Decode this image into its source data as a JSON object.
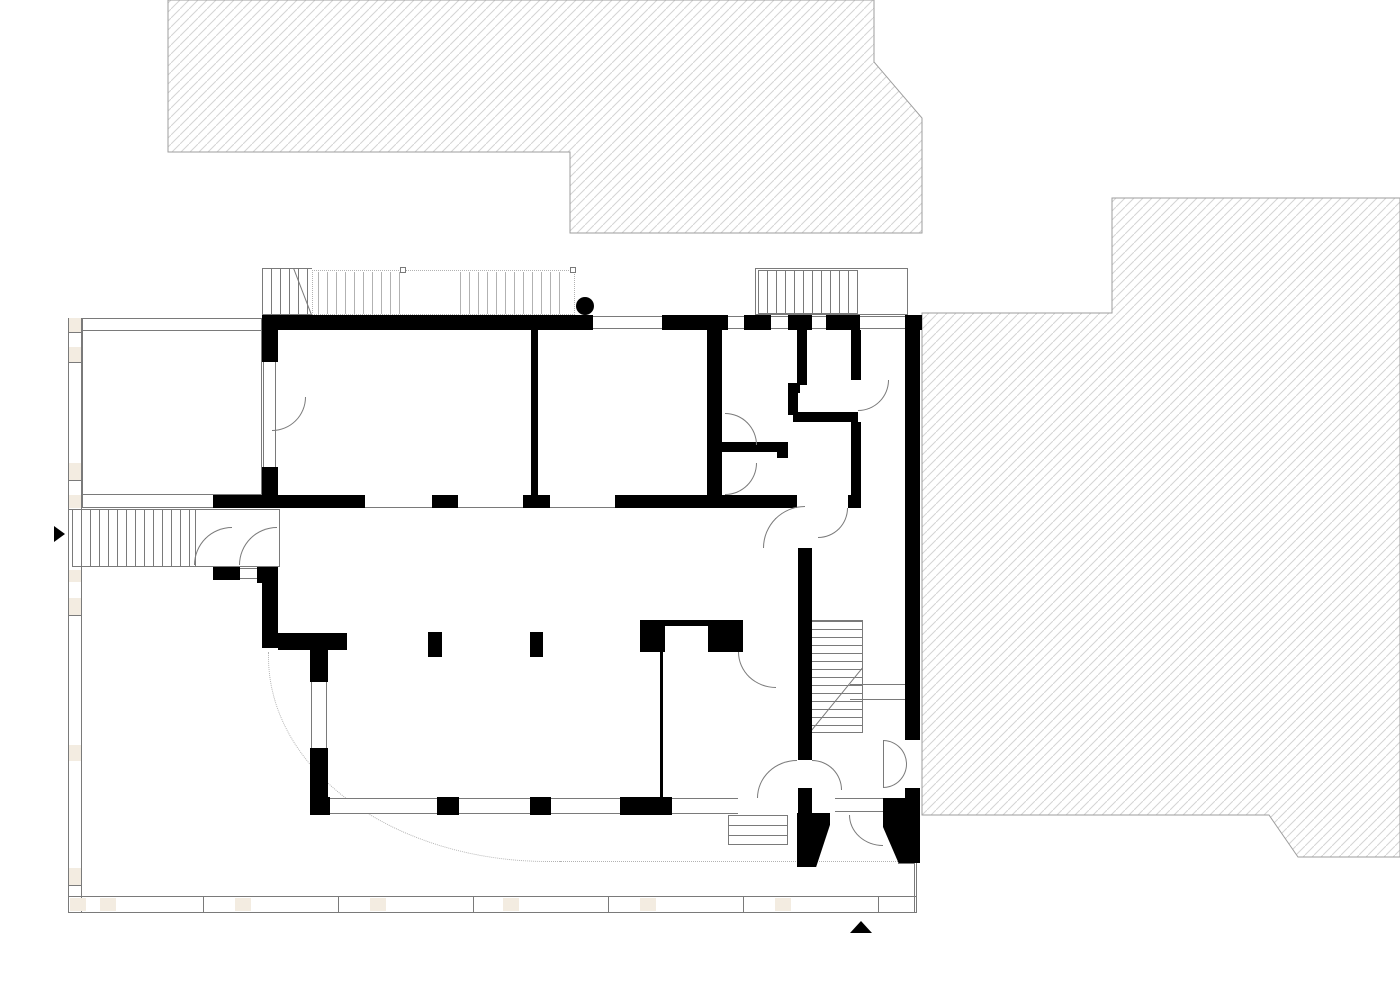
{
  "canvas": {
    "width": 1400,
    "height": 990
  },
  "colors": {
    "background": "#ffffff",
    "wall": "#000000",
    "line": "#7a7a7a",
    "lightline": "#b2b2b2",
    "beige": "#f3ece1",
    "hatchline": "#d4d4d4",
    "hatchstroke": "#9e9e9e"
  },
  "hatch_regions": [
    {
      "name": "neighbor-building-north",
      "points": "168,0 874,0 874,62 922,118 922,233 570,233 570,152 168,152"
    },
    {
      "name": "neighbor-building-east",
      "points": "1112,198 1400,198 1400,857 1298,857 1269,815 922,815 922,313 1112,313"
    }
  ],
  "elements": [
    {
      "t": "line-rect-v",
      "n": "site-boundary-left",
      "x": 68,
      "y": 318,
      "w": 14,
      "h": 595
    },
    {
      "t": "line-rect",
      "n": "site-boundary-bottom",
      "x": 68,
      "y": 896,
      "w": 849,
      "h": 17
    },
    {
      "t": "line-rect-v",
      "n": "site-boundary-corner-right",
      "x": 914,
      "y": 863,
      "w": 3,
      "h": 50
    },
    {
      "t": "line-h",
      "n": "boundary-tick",
      "x": 68,
      "y": 332,
      "w": 14,
      "h": 1
    },
    {
      "t": "line-h",
      "n": "boundary-tick",
      "x": 68,
      "y": 362,
      "w": 14,
      "h": 1
    },
    {
      "t": "line-h",
      "n": "boundary-tick",
      "x": 68,
      "y": 480,
      "w": 14,
      "h": 1
    },
    {
      "t": "line-h",
      "n": "boundary-tick",
      "x": 68,
      "y": 509,
      "w": 14,
      "h": 1
    },
    {
      "t": "line-h",
      "n": "boundary-tick",
      "x": 68,
      "y": 581,
      "w": 14,
      "h": 1
    },
    {
      "t": "line-h",
      "n": "boundary-tick",
      "x": 68,
      "y": 615,
      "w": 14,
      "h": 1
    },
    {
      "t": "line-h",
      "n": "boundary-tick",
      "x": 68,
      "y": 754,
      "w": 14,
      "h": 1
    },
    {
      "t": "line-h",
      "n": "boundary-tick",
      "x": 68,
      "y": 885,
      "w": 14,
      "h": 1
    },
    {
      "t": "line-v",
      "n": "boundary-tick",
      "x": 203,
      "y": 896,
      "w": 1,
      "h": 17
    },
    {
      "t": "line-v",
      "n": "boundary-tick",
      "x": 338,
      "y": 896,
      "w": 1,
      "h": 17
    },
    {
      "t": "line-v",
      "n": "boundary-tick",
      "x": 473,
      "y": 896,
      "w": 1,
      "h": 17
    },
    {
      "t": "line-v",
      "n": "boundary-tick",
      "x": 608,
      "y": 896,
      "w": 1,
      "h": 17
    },
    {
      "t": "line-v",
      "n": "boundary-tick",
      "x": 743,
      "y": 896,
      "w": 1,
      "h": 17
    },
    {
      "t": "line-v",
      "n": "boundary-tick",
      "x": 878,
      "y": 896,
      "w": 1,
      "h": 17
    },
    {
      "t": "beige",
      "n": "boundary-post",
      "x": 69,
      "y": 318,
      "w": 12,
      "h": 14
    },
    {
      "t": "beige",
      "n": "boundary-post",
      "x": 69,
      "y": 347,
      "w": 12,
      "h": 15
    },
    {
      "t": "beige",
      "n": "boundary-post",
      "x": 69,
      "y": 463,
      "w": 12,
      "h": 17
    },
    {
      "t": "beige",
      "n": "boundary-post",
      "x": 69,
      "y": 495,
      "w": 12,
      "h": 13
    },
    {
      "t": "beige",
      "n": "boundary-post",
      "x": 69,
      "y": 570,
      "w": 12,
      "h": 12
    },
    {
      "t": "beige",
      "n": "boundary-post",
      "x": 69,
      "y": 598,
      "w": 12,
      "h": 17
    },
    {
      "t": "beige",
      "n": "boundary-post",
      "x": 69,
      "y": 745,
      "w": 12,
      "h": 16
    },
    {
      "t": "beige",
      "n": "boundary-post",
      "x": 69,
      "y": 868,
      "w": 12,
      "h": 17
    },
    {
      "t": "beige",
      "n": "boundary-post",
      "x": 70,
      "y": 898,
      "w": 16,
      "h": 13
    },
    {
      "t": "beige",
      "n": "boundary-post",
      "x": 100,
      "y": 898,
      "w": 16,
      "h": 13
    },
    {
      "t": "beige",
      "n": "boundary-post",
      "x": 235,
      "y": 898,
      "w": 16,
      "h": 13
    },
    {
      "t": "beige",
      "n": "boundary-post",
      "x": 370,
      "y": 898,
      "w": 16,
      "h": 13
    },
    {
      "t": "beige",
      "n": "boundary-post",
      "x": 503,
      "y": 898,
      "w": 16,
      "h": 13
    },
    {
      "t": "beige",
      "n": "boundary-post",
      "x": 640,
      "y": 898,
      "w": 16,
      "h": 13
    },
    {
      "t": "beige",
      "n": "boundary-post",
      "x": 775,
      "y": 898,
      "w": 16,
      "h": 13
    },
    {
      "t": "frame",
      "n": "terrace",
      "x": 82,
      "y": 318,
      "w": 180,
      "h": 190
    },
    {
      "t": "line-h",
      "n": "terrace-inner-line",
      "x": 82,
      "y": 330,
      "w": 180,
      "h": 1
    },
    {
      "t": "line-h",
      "n": "terrace-inner-line",
      "x": 82,
      "y": 494,
      "w": 180,
      "h": 1
    },
    {
      "t": "stair-h",
      "n": "entry-stair",
      "x": 72,
      "y": 509,
      "w": 123,
      "h": 58
    },
    {
      "t": "frame",
      "n": "entry-porch",
      "x": 195,
      "y": 509,
      "w": 85,
      "h": 58
    },
    {
      "t": "line-rect",
      "n": "entry-sill",
      "x": 240,
      "y": 568,
      "w": 17,
      "h": 11
    },
    {
      "t": "stair-h",
      "n": "upper-stair-solid",
      "x": 262,
      "y": 268,
      "w": 50,
      "h": 47
    },
    {
      "t": "diag",
      "n": "stair-diagonal",
      "x": 294,
      "y": 268,
      "len": 50,
      "ang": 69
    },
    {
      "t": "dotted-rect",
      "n": "upper-stair-dotted-outline",
      "x": 312,
      "y": 270,
      "w": 263,
      "h": 45
    },
    {
      "t": "stair-dots",
      "n": "upper-stair-dotted-treads",
      "x": 318,
      "y": 272,
      "w": 86,
      "h": 42
    },
    {
      "t": "stair-dots",
      "n": "upper-stair-dotted-treads",
      "x": 460,
      "y": 272,
      "w": 108,
      "h": 42
    },
    {
      "t": "square-marker",
      "n": "stair-marker",
      "x": 400,
      "y": 267,
      "w": 6,
      "h": 6
    },
    {
      "t": "square-marker",
      "n": "stair-marker",
      "x": 570,
      "y": 267,
      "w": 6,
      "h": 6
    },
    {
      "t": "frame",
      "n": "rear-porch",
      "x": 755,
      "y": 268,
      "w": 153,
      "h": 47
    },
    {
      "t": "stair-h",
      "n": "rear-porch-stair",
      "x": 758,
      "y": 270,
      "w": 100,
      "h": 44
    },
    {
      "t": "stair-v",
      "n": "winder-stair",
      "x": 810,
      "y": 620,
      "w": 53,
      "h": 113
    },
    {
      "t": "diag",
      "n": "winder-diagonal",
      "x": 863,
      "y": 668,
      "len": 84,
      "ang": 129.2
    },
    {
      "t": "line-rect",
      "n": "stair-rail",
      "x": 850,
      "y": 684,
      "w": 55,
      "h": 16
    },
    {
      "t": "frame",
      "n": "garden-steps",
      "x": 728,
      "y": 815,
      "w": 60,
      "h": 30
    },
    {
      "t": "line-h",
      "n": "garden-step-line",
      "x": 728,
      "y": 825,
      "w": 60,
      "h": 1
    },
    {
      "t": "line-h",
      "n": "garden-step-line",
      "x": 728,
      "y": 835,
      "w": 60,
      "h": 1
    },
    {
      "t": "dotted-arc",
      "n": "canopy-outline",
      "x": 268,
      "y": 652,
      "w": 300,
      "h": 210
    },
    {
      "t": "dotted-h",
      "n": "canopy-outline",
      "x": 560,
      "y": 861,
      "w": 338,
      "h": 1
    },
    {
      "t": "line-h",
      "n": "edge-line",
      "x": 898,
      "y": 863,
      "w": 17,
      "h": 1
    },
    {
      "t": "line-h",
      "n": "wall-soffit-line",
      "x": 365,
      "y": 507,
      "w": 67,
      "h": 1
    },
    {
      "t": "line-h",
      "n": "wall-soffit-line",
      "x": 458,
      "y": 507,
      "w": 65,
      "h": 1
    },
    {
      "t": "line-h",
      "n": "wall-soffit-line",
      "x": 548,
      "y": 507,
      "w": 67,
      "h": 1
    },
    {
      "t": "wall",
      "n": "wall-segment",
      "x": 262,
      "y": 315,
      "w": 331,
      "h": 15
    },
    {
      "t": "wall",
      "n": "wall-segment",
      "x": 662,
      "y": 315,
      "w": 66,
      "h": 15
    },
    {
      "t": "wall",
      "n": "wall-segment",
      "x": 744,
      "y": 315,
      "w": 27,
      "h": 15
    },
    {
      "t": "wall",
      "n": "wall-segment",
      "x": 788,
      "y": 315,
      "w": 24,
      "h": 15
    },
    {
      "t": "wall",
      "n": "wall-segment",
      "x": 826,
      "y": 315,
      "w": 34,
      "h": 15
    },
    {
      "t": "wall",
      "n": "wall-segment",
      "x": 905,
      "y": 315,
      "w": 17,
      "h": 15
    },
    {
      "t": "wall",
      "n": "wall-segment",
      "x": 905,
      "y": 330,
      "w": 15,
      "h": 410
    },
    {
      "t": "wall",
      "n": "wall-segment",
      "x": 905,
      "y": 788,
      "w": 15,
      "h": 27
    },
    {
      "t": "wall",
      "n": "wall-segment",
      "x": 905,
      "y": 815,
      "w": 12,
      "h": 48
    },
    {
      "t": "wall",
      "n": "wall-segment",
      "x": 262,
      "y": 330,
      "w": 16,
      "h": 32
    },
    {
      "t": "wall",
      "n": "wall-segment",
      "x": 262,
      "y": 467,
      "w": 16,
      "h": 41
    },
    {
      "t": "wall",
      "n": "wall-segment",
      "x": 213,
      "y": 495,
      "w": 49,
      "h": 13
    },
    {
      "t": "wall",
      "n": "wall-segment",
      "x": 262,
      "y": 495,
      "w": 103,
      "h": 13
    },
    {
      "t": "wall",
      "n": "wall-segment",
      "x": 432,
      "y": 495,
      "w": 26,
      "h": 13
    },
    {
      "t": "wall",
      "n": "wall-segment",
      "x": 523,
      "y": 495,
      "w": 27,
      "h": 13
    },
    {
      "t": "wall",
      "n": "wall-segment",
      "x": 615,
      "y": 495,
      "w": 182,
      "h": 13
    },
    {
      "t": "wall",
      "n": "wall-segment",
      "x": 848,
      "y": 495,
      "w": 13,
      "h": 13
    },
    {
      "t": "wall",
      "n": "wall-segment",
      "x": 531,
      "y": 330,
      "w": 7,
      "h": 165
    },
    {
      "t": "wall",
      "n": "wall-segment",
      "x": 707,
      "y": 330,
      "w": 15,
      "h": 178
    },
    {
      "t": "wall",
      "n": "wall-segment",
      "x": 797,
      "y": 330,
      "w": 10,
      "h": 55
    },
    {
      "t": "wall",
      "n": "wall-segment",
      "x": 788,
      "y": 383,
      "w": 12,
      "h": 10
    },
    {
      "t": "wall",
      "n": "wall-segment",
      "x": 788,
      "y": 393,
      "w": 10,
      "h": 22
    },
    {
      "t": "wall",
      "n": "wall-segment",
      "x": 793,
      "y": 412,
      "w": 65,
      "h": 10
    },
    {
      "t": "wall",
      "n": "wall-segment",
      "x": 851,
      "y": 422,
      "w": 10,
      "h": 73
    },
    {
      "t": "wall",
      "n": "wall-segment",
      "x": 851,
      "y": 330,
      "w": 10,
      "h": 50
    },
    {
      "t": "wall",
      "n": "wall-segment",
      "x": 722,
      "y": 442,
      "w": 66,
      "h": 10
    },
    {
      "t": "wall",
      "n": "wall-segment",
      "x": 777,
      "y": 445,
      "w": 11,
      "h": 13
    },
    {
      "t": "wall",
      "n": "wall-segment",
      "x": 213,
      "y": 567,
      "w": 27,
      "h": 13
    },
    {
      "t": "wall",
      "n": "wall-segment",
      "x": 257,
      "y": 567,
      "w": 21,
      "h": 16
    },
    {
      "t": "wall",
      "n": "wall-segment",
      "x": 262,
      "y": 567,
      "w": 16,
      "h": 81
    },
    {
      "t": "wall",
      "n": "wall-segment",
      "x": 278,
      "y": 633,
      "w": 69,
      "h": 17
    },
    {
      "t": "wall",
      "n": "wall-segment",
      "x": 310,
      "y": 650,
      "w": 18,
      "h": 32
    },
    {
      "t": "wall",
      "n": "wall-segment",
      "x": 310,
      "y": 748,
      "w": 18,
      "h": 50
    },
    {
      "t": "wall",
      "n": "wall-segment",
      "x": 310,
      "y": 797,
      "w": 20,
      "h": 18
    },
    {
      "t": "wall",
      "n": "wall-segment",
      "x": 437,
      "y": 797,
      "w": 22,
      "h": 18
    },
    {
      "t": "wall",
      "n": "wall-segment",
      "x": 530,
      "y": 797,
      "w": 21,
      "h": 18
    },
    {
      "t": "wall",
      "n": "wall-segment",
      "x": 620,
      "y": 797,
      "w": 52,
      "h": 18
    },
    {
      "t": "wall",
      "n": "niche-wall",
      "x": 640,
      "y": 620,
      "w": 103,
      "h": 32
    },
    {
      "t": "white-inset",
      "n": "niche-opening",
      "x": 665,
      "y": 626,
      "w": 43,
      "h": 26
    },
    {
      "t": "wall",
      "n": "pillar",
      "x": 428,
      "y": 632,
      "w": 14,
      "h": 25
    },
    {
      "t": "wall",
      "n": "pillar",
      "x": 530,
      "y": 632,
      "w": 13,
      "h": 25
    },
    {
      "t": "wall",
      "n": "partition-wall",
      "x": 660,
      "y": 652,
      "w": 3,
      "h": 145
    },
    {
      "t": "wall",
      "n": "wall-segment",
      "x": 798,
      "y": 548,
      "w": 14,
      "h": 212
    },
    {
      "t": "wall",
      "n": "wall-segment",
      "x": 798,
      "y": 788,
      "w": 14,
      "h": 27
    },
    {
      "t": "wall",
      "n": "wall-segment",
      "x": 883,
      "y": 798,
      "w": 24,
      "h": 17
    },
    {
      "t": "jamb-left",
      "n": "entrance-jamb",
      "x": 797,
      "y": 813,
      "w": 33,
      "h": 54
    },
    {
      "t": "jamb-right",
      "n": "entrance-jamb",
      "x": 883,
      "y": 813,
      "w": 37,
      "h": 50
    },
    {
      "t": "window-h",
      "n": "window",
      "x": 593,
      "y": 316,
      "w": 69,
      "h": 13
    },
    {
      "t": "window-h",
      "n": "window",
      "x": 728,
      "y": 316,
      "w": 16,
      "h": 13
    },
    {
      "t": "window-h",
      "n": "window",
      "x": 771,
      "y": 316,
      "w": 17,
      "h": 13
    },
    {
      "t": "window-h",
      "n": "window",
      "x": 812,
      "y": 316,
      "w": 14,
      "h": 13
    },
    {
      "t": "window-h",
      "n": "porch-door-glazing",
      "x": 860,
      "y": 316,
      "w": 45,
      "h": 13
    },
    {
      "t": "window-h",
      "n": "window",
      "x": 330,
      "y": 798,
      "w": 107,
      "h": 16
    },
    {
      "t": "window-h",
      "n": "window",
      "x": 459,
      "y": 798,
      "w": 71,
      "h": 16
    },
    {
      "t": "window-h",
      "n": "window",
      "x": 551,
      "y": 798,
      "w": 69,
      "h": 16
    },
    {
      "t": "window-h",
      "n": "window",
      "x": 672,
      "y": 798,
      "w": 66,
      "h": 16
    },
    {
      "t": "window-h",
      "n": "entrance-sidelight",
      "x": 835,
      "y": 798,
      "w": 48,
      "h": 14
    },
    {
      "t": "window-v",
      "n": "french-window",
      "x": 263,
      "y": 362,
      "w": 13,
      "h": 105
    },
    {
      "t": "window-v",
      "n": "window",
      "x": 311,
      "y": 682,
      "w": 16,
      "h": 66
    },
    {
      "t": "door",
      "c": "tl",
      "n": "door-swing",
      "x": 194,
      "y": 527,
      "w": 38,
      "h": 38
    },
    {
      "t": "door",
      "c": "tl",
      "n": "door-swing",
      "x": 239,
      "y": 527,
      "w": 38,
      "h": 38
    },
    {
      "t": "door",
      "c": "br",
      "n": "door-swing",
      "x": 272,
      "y": 397,
      "w": 34,
      "h": 34
    },
    {
      "t": "door",
      "c": "tr",
      "n": "door-swing",
      "x": 725,
      "y": 413,
      "w": 32,
      "h": 32
    },
    {
      "t": "door",
      "c": "br",
      "n": "door-swing",
      "x": 725,
      "y": 463,
      "w": 32,
      "h": 32
    },
    {
      "t": "door",
      "c": "br",
      "n": "door-swing",
      "x": 858,
      "y": 380,
      "w": 31,
      "h": 31
    },
    {
      "t": "door",
      "c": "tl",
      "n": "door-swing",
      "x": 763,
      "y": 506,
      "w": 42,
      "h": 42
    },
    {
      "t": "door",
      "c": "br",
      "n": "door-swing",
      "x": 818,
      "y": 508,
      "w": 30,
      "h": 30
    },
    {
      "t": "door",
      "c": "bl",
      "n": "door-swing",
      "x": 738,
      "y": 652,
      "w": 38,
      "h": 36
    },
    {
      "t": "door",
      "c": "tl",
      "n": "garden-door-swing",
      "x": 757,
      "y": 760,
      "w": 40,
      "h": 38
    },
    {
      "t": "door",
      "c": "bl",
      "n": "entrance-door-swing",
      "x": 849,
      "y": 815,
      "w": 34,
      "h": 31
    },
    {
      "t": "door",
      "c": "tr",
      "n": "double-door-swing",
      "x": 883,
      "y": 740,
      "w": 24,
      "h": 24
    },
    {
      "t": "door",
      "c": "br",
      "n": "double-door-swing",
      "x": 883,
      "y": 764,
      "w": 24,
      "h": 24
    },
    {
      "t": "door",
      "c": "tr",
      "n": "door-swing",
      "x": 812,
      "y": 760,
      "w": 30,
      "h": 30
    },
    {
      "t": "line-v",
      "n": "door-leaf",
      "x": 883,
      "y": 740,
      "w": 1,
      "h": 48
    },
    {
      "t": "circle-marker",
      "n": "column-marker",
      "x": 576,
      "y": 297,
      "w": 18,
      "h": 18
    },
    {
      "t": "triangle-right",
      "n": "entry-arrow",
      "x": 54,
      "y": 526,
      "w": 0,
      "h": 0
    },
    {
      "t": "triangle-up",
      "n": "north-arrow",
      "x": 850,
      "y": 921,
      "w": 0,
      "h": 0
    }
  ]
}
